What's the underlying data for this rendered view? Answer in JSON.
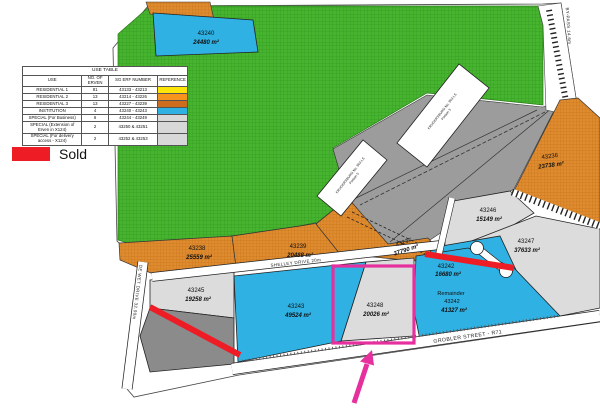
{
  "use_table": {
    "title": "USE TABLE",
    "columns": [
      "USE",
      "NO. OF ERVEN",
      "SG ERF NUMBER",
      "REFERENCE"
    ],
    "rows": [
      {
        "use": "RESIDENTIAL 1",
        "erven": "81",
        "sg_erf": "43133 - 43213",
        "ref_color": "#ffe40a"
      },
      {
        "use": "RESIDENTIAL 2",
        "erven": "13",
        "sg_erf": "43214 - 43226",
        "ref_color": "#f7941d"
      },
      {
        "use": "RESIDENTIAL 3",
        "erven": "13",
        "sg_erf": "43227 - 43239",
        "ref_color": "#cb6d1c"
      },
      {
        "use": "INSTITUTION",
        "erven": "4",
        "sg_erf": "43240 - 43243",
        "ref_color": "#2fb1e3"
      },
      {
        "use": "SPECIAL (For Business)",
        "erven": "6",
        "sg_erf": "43244 - 43249",
        "ref_color": "#d8d8d8"
      },
      {
        "use": "SPECIAL (Extension of Erven in X124)",
        "erven": "2",
        "sg_erf": "43250 & 43251",
        "ref_color": "#d8d8d8"
      },
      {
        "use": "SPECIAL (For delivery access - X124)",
        "erven": "2",
        "sg_erf": "43252 & 43253",
        "ref_color": "#d8d8d8"
      }
    ]
  },
  "legend": {
    "sold_label": "Sold",
    "sold_color": "#ee1c25"
  },
  "parcels": {
    "p43240": {
      "id": "43240",
      "area": "24480 m²"
    },
    "p43238": {
      "id": "43238",
      "area": "25559 m²"
    },
    "p43239": {
      "id": "43239",
      "area": "20488 m²"
    },
    "p43237": {
      "id": "43237",
      "area": "37790 m²"
    },
    "p43236": {
      "id": "43236",
      "area": "23738 m²"
    },
    "p43246": {
      "id": "43246",
      "area": "15149 m²"
    },
    "p43247": {
      "id": "43247",
      "area": "37633 m²"
    },
    "p43242": {
      "id": "43242",
      "area": "16680 m²"
    },
    "remainder": {
      "prefix": "Remainder",
      "id": "43242",
      "area": "41327 m²"
    },
    "p43248": {
      "id": "43248",
      "area": "20026 m²"
    },
    "p43243": {
      "id": "43243",
      "area": "49524 m²"
    },
    "p43245": {
      "id": "43245",
      "area": "19258 m²"
    }
  },
  "roads": {
    "shelley": "SHELLEY DRIVE 20m",
    "de_wet": "DE WET DRIVE 32.00m",
    "grobler": "GROBLER STREET - R71",
    "bypass": "BY-PASS 14.6m"
  },
  "buildings": {
    "portion3_line1": "KRUGERSBURG No. 963-LS",
    "portion3_line2": "Portion 3",
    "portion5_line1": "KRUGERSBURG No. 963-LS",
    "portion5_line2": "Portion 5"
  },
  "map_colors": {
    "green": "#46b42e",
    "orange": "#df8b2f",
    "blue": "#2fb1e3",
    "gray_band": "#9c9c9c",
    "gray_parcel": "#dcdcdc",
    "dark_gray_parcel": "#8b8b8b"
  },
  "annotations": {
    "highlight_color": "#e6309e"
  }
}
